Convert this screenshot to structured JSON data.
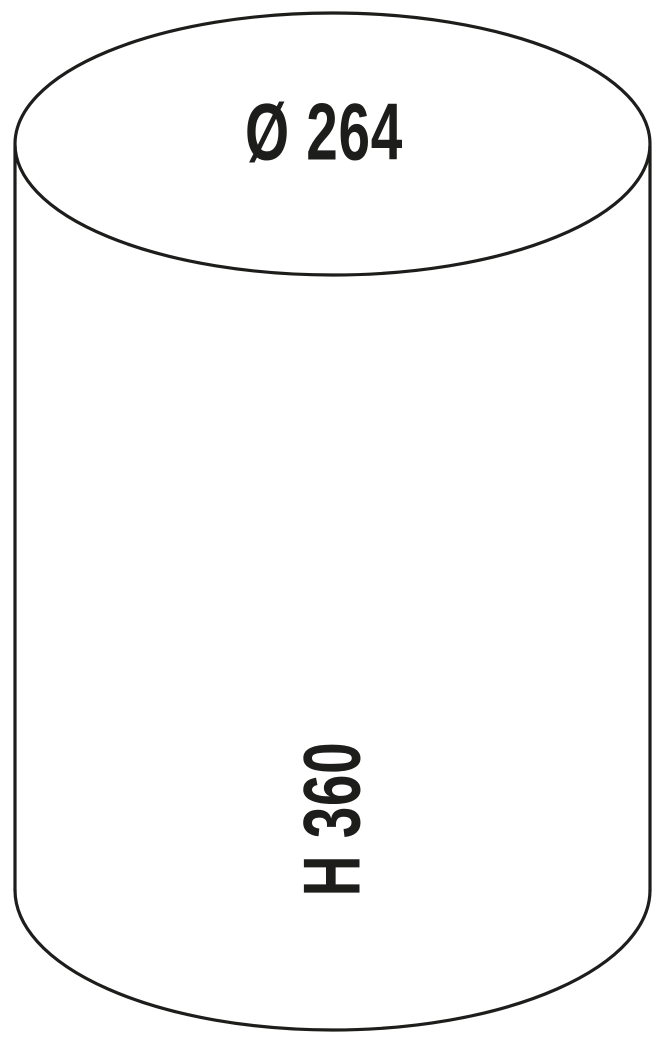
{
  "diagram": {
    "labels": {
      "diameter": "Ø 264",
      "height": "H 360"
    },
    "colors": {
      "background": "#ffffff",
      "line": "#1d1d1b",
      "text": "#1d1d1b"
    }
  }
}
